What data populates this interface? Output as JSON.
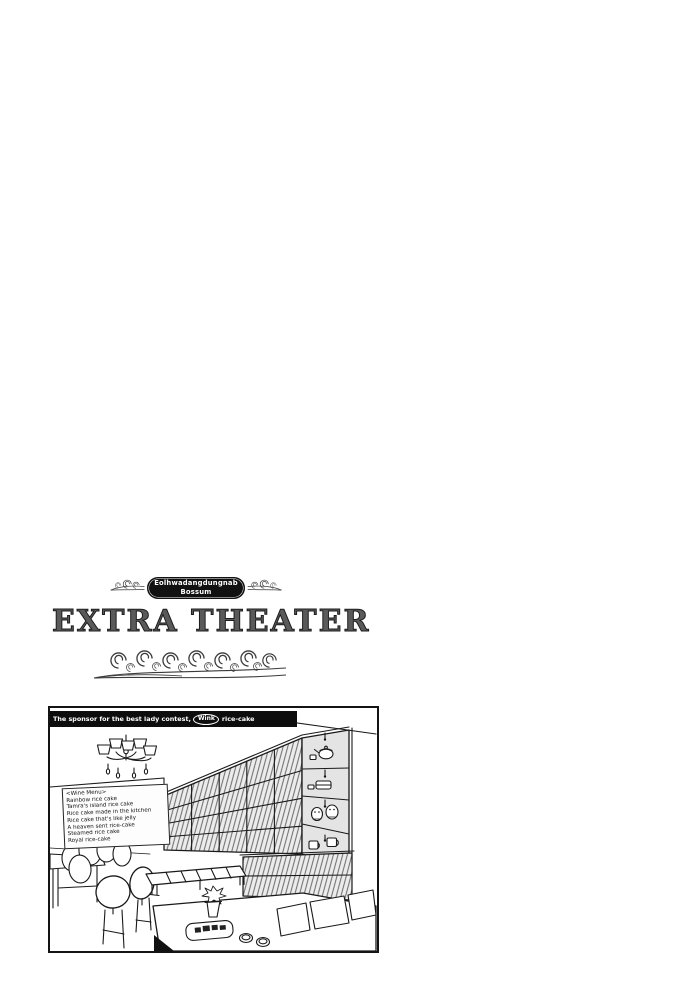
{
  "page": {
    "background": "#ffffff"
  },
  "header": {
    "series_badge": {
      "line1": "Eolhwadangdungnab",
      "line2": "Bossum"
    },
    "title": "EXTRA THEATER"
  },
  "panel": {
    "banner": {
      "prefix": "The sponsor for the best lady contest,",
      "sponsor_name": "Wink",
      "suffix": "rice-cake"
    },
    "menu_board": {
      "title": "<Wine Menu>",
      "items": [
        "Rainbow rice cake",
        "Tamra's island rice cake",
        "Rice cake made in the kitchen",
        "Rice cake that's like jelly",
        "A heaven sent rice-cake",
        "Steamed rice cake",
        "Royal rice-cake"
      ]
    },
    "scene_objects": [
      "chandelier",
      "menu-board",
      "shelf-wall",
      "teapot",
      "lidded-box",
      "chick-figurines",
      "mugs",
      "bench",
      "cafe-tables",
      "oval-back-chairs",
      "rice-cake-tray",
      "tea-cups",
      "potted-plant",
      "seat-panels"
    ]
  },
  "colors": {
    "ink": "#1a1a1a",
    "banner_bg": "#0d0d0d",
    "banner_text": "#ffffff",
    "badge_bg": "#111111",
    "shelf_tone": "#e4e4e4"
  }
}
